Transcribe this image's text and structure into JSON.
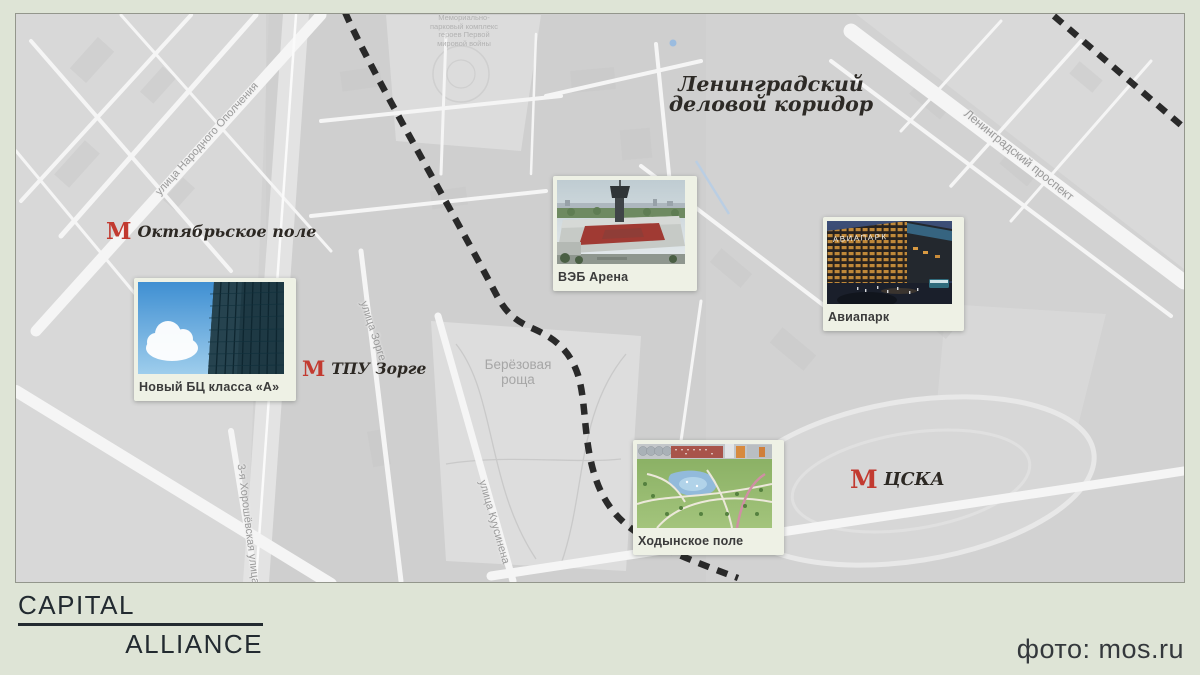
{
  "colors": {
    "page_background": "#dee4d6",
    "map_background": "#d2d2d2",
    "metro_red": "#c23a30",
    "dash_line": "#1c1c1c",
    "card_background": "#eef1e5"
  },
  "map": {
    "corridor_title_lines": [
      "Ленинградский",
      "деловой коридор"
    ],
    "memorial_label_lines": [
      "Мемориально-",
      "парковый комплекс",
      "героев Первой",
      "мировой войны"
    ],
    "park_label_lines": [
      "Берёзовая",
      "роща"
    ],
    "street_labels": [
      {
        "name": "улица Народного Ополчения"
      },
      {
        "name": "улица Зорге"
      },
      {
        "name": "улица Куусинена"
      },
      {
        "name": "3-я Хорошёвская улица"
      },
      {
        "name": "Ленинградский проспект"
      }
    ],
    "metro_stations": [
      {
        "symbol": "М",
        "name": "Октябрьское поле"
      },
      {
        "symbol": "М",
        "name": "ТПУ Зорге"
      },
      {
        "symbol": "М",
        "name": "ЦСКА"
      }
    ],
    "cards": [
      {
        "label": "Новый БЦ класса «А»",
        "photo": "office-tower-facade-and-sky"
      },
      {
        "label": "ВЭБ Арена",
        "photo": "stadium-aerial-view"
      },
      {
        "label": "Авиапарк",
        "photo": "mall-evening-view",
        "sign": "АВИАПАРК"
      },
      {
        "label": "Ходынское поле",
        "photo": "park-aerial-view"
      }
    ]
  },
  "footer": {
    "logo_line1": "CAPITAL",
    "logo_line2": "ALLIANCE",
    "photo_credit": "фото: mos.ru"
  }
}
